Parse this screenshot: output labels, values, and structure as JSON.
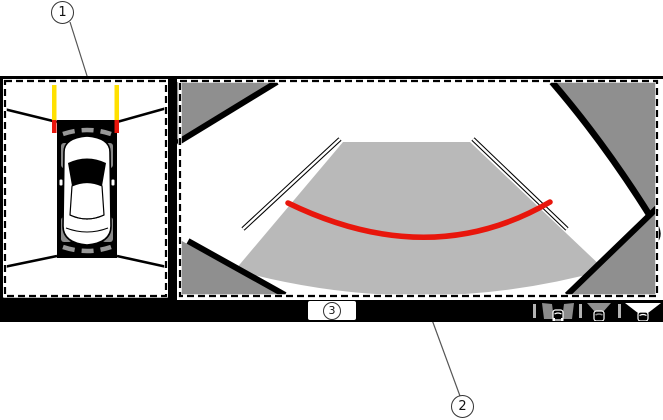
{
  "callouts": {
    "one": {
      "label": "1"
    },
    "two": {
      "label": "2"
    },
    "three": {
      "label": "3"
    }
  },
  "display": {
    "left_panel": {
      "name": "birds-eye-view"
    },
    "right_panel": {
      "name": "wide-rear-view"
    },
    "colors": {
      "guide_yellow": "#ffe000",
      "guide_red": "#e8160c",
      "corner_gray": "#8f8f8f",
      "ground_gray": "#b9b9b9",
      "bar_black": "#000000",
      "wheel_gray": "#8a8a8a"
    }
  },
  "toolbar": {
    "buttons": [
      {
        "name": "side-cameras-view"
      },
      {
        "name": "rear-view"
      },
      {
        "name": "wide-rear-view"
      }
    ]
  }
}
